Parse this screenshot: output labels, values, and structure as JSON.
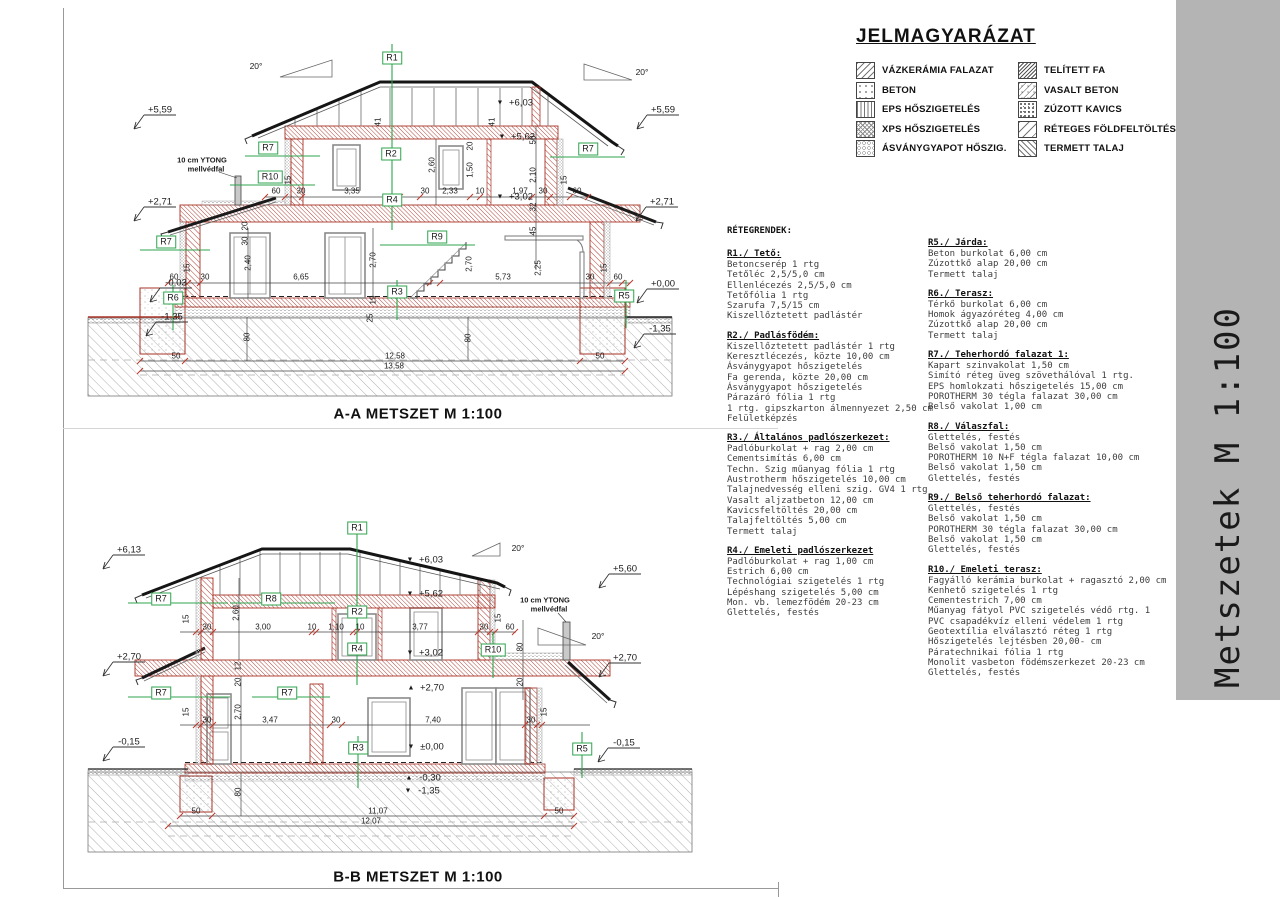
{
  "titlebar": {
    "text": "Metszetek M 1:100",
    "bg": "#b4b4b4"
  },
  "legend": {
    "title": "JELMAGYARÁZAT",
    "items_left": [
      {
        "label": "VÁZKERÁMIA FALAZAT",
        "pattern": "diag"
      },
      {
        "label": "BETON",
        "pattern": "dots"
      },
      {
        "label": "EPS HŐSZIGETELÉS",
        "pattern": "zigzag"
      },
      {
        "label": "XPS HŐSZIGETELÉS",
        "pattern": "honey"
      },
      {
        "label": "ÁSVÁNYGYAPOT HŐSZIG.",
        "pattern": "wavy"
      }
    ],
    "items_right": [
      {
        "label": "TELÍTETT FA",
        "pattern": "wood"
      },
      {
        "label": "VASALT BETON",
        "pattern": "rebar"
      },
      {
        "label": "ZÚZOTT KAVICS",
        "pattern": "gravel"
      },
      {
        "label": "RÉTEGES FÖLDFELTÖLTÉS",
        "pattern": "fill"
      },
      {
        "label": "TERMETT TALAJ",
        "pattern": "soil"
      }
    ]
  },
  "layers": {
    "heading": "RÉTEGRENDEK:",
    "left": [
      {
        "title": "R1./ Tető:",
        "lines": [
          "Betoncserép 1 rtg",
          "Tetőléc 2,5/5,0 cm",
          "Ellenlécezés 2,5/5,0 cm",
          "Tetőfólia 1 rtg",
          "Szarufa 7,5/15 cm",
          "Kiszellőztetett padlástér"
        ]
      },
      {
        "title": "R2./ Padlásfödém:",
        "lines": [
          "Kiszellőztetett padlástér 1 rtg",
          "Keresztlécezés, közte 10,00 cm",
          "Ásványgyapot hőszigetelés",
          "Fa gerenda, közte 20,00 cm",
          "Ásványgyapot hőszigetelés",
          "Párazáró fólia 1 rtg",
          "1 rtg. gipszkarton álmennyezet 2,50 cm",
          "Felületképzés"
        ]
      },
      {
        "title": "R3./ Általános padlószerkezet:",
        "lines": [
          "Padlóburkolat + rag 2,00 cm",
          "Cementsimítás 6,00 cm",
          "Techn. Szig műanyag fólia 1 rtg",
          "Austrotherm hőszigetelés 10,00 cm",
          "Talajnedvesség elleni szig. GV4 1 rtg",
          "Vasalt aljzatbeton 12,00 cm",
          "Kavicsfeltöltés 20,00 cm",
          "Talajfeltöltés 5,00 cm",
          "Termett talaj"
        ]
      },
      {
        "title": "R4./ Emeleti padlószerkezet",
        "lines": [
          "Padlóburkolat + rag 1,00 cm",
          "Estrich 6,00 cm",
          "Technológiai szigetelés 1 rtg",
          "Lépéshang szigetelés 5,00 cm",
          "Mon. vb. lemezfödém 20-23 cm",
          "Glettelés, festés"
        ]
      }
    ],
    "right": [
      {
        "title": "R5./ Járda:",
        "lines": [
          "Beton burkolat 6,00 cm",
          "Zúzottkő alap 20,00 cm",
          "Termett talaj"
        ]
      },
      {
        "title": "R6./ Terasz:",
        "lines": [
          "Térkő burkolat 6,00 cm",
          "Homok ágyazóréteg 4,00 cm",
          "Zúzottkő alap 20,00 cm",
          "Termett talaj"
        ]
      },
      {
        "title": "R7./ Teherhordó falazat 1:",
        "lines": [
          "Kapart szinvakolat 1,50 cm",
          "Simító réteg üveg szövethálóval 1 rtg.",
          "EPS homlokzati hőszigetelés 15,00 cm",
          "POROTHERM 30 tégla falazat 30,00 cm",
          "Belső vakolat 1,00 cm"
        ]
      },
      {
        "title": "R8./ Válaszfal:",
        "lines": [
          "Glettelés, festés",
          "Belső vakolat 1,50 cm",
          "POROTHERM 10 N+F tégla falazat 10,00 cm",
          "Belső vakolat 1,50 cm",
          "Glettelés, festés"
        ]
      },
      {
        "title": "R9./ Belső teherhordó falazat:",
        "lines": [
          "Glettelés, festés",
          "Belső vakolat 1,50 cm",
          "POROTHERM 30 tégla falazat 30,00 cm",
          "Belső vakolat 1,50 cm",
          "Glettelés, festés"
        ]
      },
      {
        "title": "R10./ Emeleti terasz:",
        "lines": [
          "Fagyálló kerámia burkolat + ragasztó 2,00 cm",
          "Kenhető szigetelés  1 rtg",
          "Cementestrich  7,00 cm",
          "Műanyag fátyol PVC szigetelés védő rtg.  1",
          "PVC csapadékvíz elleni védelem 1 rtg",
          "Geotextília elválasztó réteg  1 rtg",
          "Hőszigetelés lejtésben  20,00- cm",
          "Páratechnikai fólia 1 rtg",
          "Monolit vasbeton födémszerkezet 20-23 cm",
          "Glettelés, festés"
        ]
      }
    ]
  },
  "section_a": {
    "title": "A-A METSZET M 1:100",
    "labels": [
      {
        "t": "+5,59",
        "x": 80,
        "y": 80,
        "cls": "elev"
      },
      {
        "t": "+2,71",
        "x": 80,
        "y": 172,
        "cls": "elev"
      },
      {
        "t": "-0,03",
        "x": 96,
        "y": 253,
        "cls": "elev"
      },
      {
        "t": "-1,35",
        "x": 92,
        "y": 287,
        "cls": "elev"
      },
      {
        "t": "+5,59",
        "x": 583,
        "y": 80,
        "cls": "elev"
      },
      {
        "t": "+2,71",
        "x": 582,
        "y": 172,
        "cls": "elev"
      },
      {
        "t": "+0,00",
        "x": 583,
        "y": 254,
        "cls": "elev"
      },
      {
        "t": "-1,35",
        "x": 580,
        "y": 299,
        "cls": "elev"
      },
      {
        "t": "▼",
        "x": 420,
        "y": 73,
        "cls": "tri"
      },
      {
        "t": "+6,03",
        "x": 441,
        "y": 73,
        "cls": "elev"
      },
      {
        "t": "▼",
        "x": 422,
        "y": 107,
        "cls": "tri"
      },
      {
        "t": "+5,62",
        "x": 443,
        "y": 107,
        "cls": "elev"
      },
      {
        "t": "▼",
        "x": 420,
        "y": 167,
        "cls": "tri"
      },
      {
        "t": "+3,02",
        "x": 441,
        "y": 167,
        "cls": "elev"
      },
      {
        "t": "20°",
        "x": 176,
        "y": 36,
        "cls": "deg"
      },
      {
        "t": "20°",
        "x": 562,
        "y": 42,
        "cls": "deg"
      },
      {
        "t": "R1",
        "x": 312,
        "y": 28,
        "cls": "rbox"
      },
      {
        "t": "R2",
        "x": 311,
        "y": 124,
        "cls": "rbox"
      },
      {
        "t": "R4",
        "x": 312,
        "y": 170,
        "cls": "rbox"
      },
      {
        "t": "R7",
        "x": 188,
        "y": 118,
        "cls": "rbox"
      },
      {
        "t": "R10",
        "x": 190,
        "y": 147,
        "cls": "rbox"
      },
      {
        "t": "R7",
        "x": 86,
        "y": 212,
        "cls": "rbox"
      },
      {
        "t": "R9",
        "x": 357,
        "y": 207,
        "cls": "rbox"
      },
      {
        "t": "R3",
        "x": 317,
        "y": 262,
        "cls": "rbox"
      },
      {
        "t": "R6",
        "x": 93,
        "y": 268,
        "cls": "rbox"
      },
      {
        "t": "R7",
        "x": 508,
        "y": 119,
        "cls": "rbox"
      },
      {
        "t": "R5",
        "x": 544,
        "y": 266,
        "cls": "rbox"
      },
      {
        "t": "10 cm YTONG",
        "x": 122,
        "y": 130,
        "cls": "note"
      },
      {
        "t": "mellvédfal",
        "x": 126,
        "y": 139,
        "cls": "note"
      },
      {
        "t": "60",
        "x": 196,
        "y": 161,
        "cls": "dim"
      },
      {
        "t": "30",
        "x": 221,
        "y": 161,
        "cls": "dim"
      },
      {
        "t": "3,35",
        "x": 272,
        "y": 161,
        "cls": "dim"
      },
      {
        "t": "30",
        "x": 345,
        "y": 161,
        "cls": "dim"
      },
      {
        "t": "2,33",
        "x": 370,
        "y": 161,
        "cls": "dim"
      },
      {
        "t": "10",
        "x": 400,
        "y": 161,
        "cls": "dim"
      },
      {
        "t": "1,97",
        "x": 440,
        "y": 161,
        "cls": "dim"
      },
      {
        "t": "30",
        "x": 463,
        "y": 161,
        "cls": "dim"
      },
      {
        "t": "60",
        "x": 497,
        "y": 161,
        "cls": "dim"
      },
      {
        "t": "15",
        "x": 484,
        "y": 150,
        "cls": "dimv"
      },
      {
        "t": "15",
        "x": 208,
        "y": 150,
        "cls": "dimv"
      },
      {
        "t": "2,60",
        "x": 352,
        "y": 135,
        "cls": "dimv"
      },
      {
        "t": "1,50",
        "x": 390,
        "y": 140,
        "cls": "dimv"
      },
      {
        "t": "20",
        "x": 390,
        "y": 116,
        "cls": "dimv"
      },
      {
        "t": "41",
        "x": 298,
        "y": 92,
        "cls": "dimv"
      },
      {
        "t": "41",
        "x": 412,
        "y": 92,
        "cls": "dimv"
      },
      {
        "t": "50",
        "x": 453,
        "y": 110,
        "cls": "dimv"
      },
      {
        "t": "2,10",
        "x": 453,
        "y": 145,
        "cls": "dimv"
      },
      {
        "t": "32",
        "x": 453,
        "y": 177,
        "cls": "dimv"
      },
      {
        "t": "45",
        "x": 453,
        "y": 201,
        "cls": "dimv"
      },
      {
        "t": "20",
        "x": 165,
        "y": 196,
        "cls": "dimv"
      },
      {
        "t": "30",
        "x": 165,
        "y": 211,
        "cls": "dimv"
      },
      {
        "t": "60",
        "x": 94,
        "y": 247,
        "cls": "dim"
      },
      {
        "t": "30",
        "x": 125,
        "y": 247,
        "cls": "dim"
      },
      {
        "t": "6,65",
        "x": 221,
        "y": 247,
        "cls": "dim"
      },
      {
        "t": "5,73",
        "x": 423,
        "y": 247,
        "cls": "dim"
      },
      {
        "t": "30",
        "x": 510,
        "y": 247,
        "cls": "dim"
      },
      {
        "t": "60",
        "x": 538,
        "y": 247,
        "cls": "dim"
      },
      {
        "t": "15",
        "x": 107,
        "y": 238,
        "cls": "dimv"
      },
      {
        "t": "15",
        "x": 524,
        "y": 238,
        "cls": "dimv"
      },
      {
        "t": "2,40",
        "x": 168,
        "y": 233,
        "cls": "dimv"
      },
      {
        "t": "2,70",
        "x": 293,
        "y": 230,
        "cls": "dimv"
      },
      {
        "t": "2,70",
        "x": 389,
        "y": 234,
        "cls": "dimv"
      },
      {
        "t": "2,25",
        "x": 458,
        "y": 238,
        "cls": "dimv"
      },
      {
        "t": "19",
        "x": 293,
        "y": 270,
        "cls": "dimv"
      },
      {
        "t": "25",
        "x": 290,
        "y": 288,
        "cls": "dimv"
      },
      {
        "t": "80",
        "x": 167,
        "y": 307,
        "cls": "dimv"
      },
      {
        "t": "80",
        "x": 388,
        "y": 308,
        "cls": "dimv"
      },
      {
        "t": "50",
        "x": 96,
        "y": 326,
        "cls": "dim"
      },
      {
        "t": "12,58",
        "x": 315,
        "y": 326,
        "cls": "dim"
      },
      {
        "t": "50",
        "x": 520,
        "y": 326,
        "cls": "dim"
      },
      {
        "t": "13,58",
        "x": 314,
        "y": 336,
        "cls": "dim"
      }
    ]
  },
  "section_b": {
    "title": "B-B METSZET M 1:100",
    "labels": [
      {
        "t": "+6,13",
        "x": 49,
        "y": 30,
        "cls": "elev"
      },
      {
        "t": "+2,70",
        "x": 49,
        "y": 137,
        "cls": "elev"
      },
      {
        "t": "-0,15",
        "x": 49,
        "y": 222,
        "cls": "elev"
      },
      {
        "t": "+5,60",
        "x": 545,
        "y": 49,
        "cls": "elev"
      },
      {
        "t": "+2,70",
        "x": 545,
        "y": 138,
        "cls": "elev"
      },
      {
        "t": "-0,15",
        "x": 544,
        "y": 223,
        "cls": "elev"
      },
      {
        "t": "▼",
        "x": 330,
        "y": 40,
        "cls": "tri"
      },
      {
        "t": "+6,03",
        "x": 351,
        "y": 40,
        "cls": "elev"
      },
      {
        "t": "▼",
        "x": 330,
        "y": 74,
        "cls": "tri"
      },
      {
        "t": "+5,62",
        "x": 351,
        "y": 74,
        "cls": "elev"
      },
      {
        "t": "▼",
        "x": 330,
        "y": 133,
        "cls": "tri"
      },
      {
        "t": "+3,02",
        "x": 351,
        "y": 133,
        "cls": "elev"
      },
      {
        "t": "▲",
        "x": 331,
        "y": 168,
        "cls": "tri"
      },
      {
        "t": "+2,70",
        "x": 352,
        "y": 168,
        "cls": "elev"
      },
      {
        "t": "▼",
        "x": 331,
        "y": 227,
        "cls": "tri"
      },
      {
        "t": "±0,00",
        "x": 352,
        "y": 227,
        "cls": "elev"
      },
      {
        "t": "▲",
        "x": 329,
        "y": 258,
        "cls": "tri"
      },
      {
        "t": "-0,30",
        "x": 350,
        "y": 258,
        "cls": "elev"
      },
      {
        "t": "▼",
        "x": 328,
        "y": 271,
        "cls": "tri"
      },
      {
        "t": "-1,35",
        "x": 349,
        "y": 271,
        "cls": "elev"
      },
      {
        "t": "20°",
        "x": 438,
        "y": 28,
        "cls": "deg"
      },
      {
        "t": "20°",
        "x": 518,
        "y": 116,
        "cls": "deg"
      },
      {
        "t": "R1",
        "x": 277,
        "y": 8,
        "cls": "rbox"
      },
      {
        "t": "R2",
        "x": 277,
        "y": 92,
        "cls": "rbox"
      },
      {
        "t": "R4",
        "x": 277,
        "y": 129,
        "cls": "rbox"
      },
      {
        "t": "R8",
        "x": 191,
        "y": 79,
        "cls": "rbox"
      },
      {
        "t": "R7",
        "x": 81,
        "y": 79,
        "cls": "rbox"
      },
      {
        "t": "R7",
        "x": 81,
        "y": 173,
        "cls": "rbox"
      },
      {
        "t": "R7",
        "x": 207,
        "y": 173,
        "cls": "rbox"
      },
      {
        "t": "R10",
        "x": 413,
        "y": 130,
        "cls": "rbox"
      },
      {
        "t": "R3",
        "x": 278,
        "y": 228,
        "cls": "rbox"
      },
      {
        "t": "R5",
        "x": 502,
        "y": 229,
        "cls": "rbox"
      },
      {
        "t": "10 cm YTONG",
        "x": 465,
        "y": 80,
        "cls": "note"
      },
      {
        "t": "mellvédfal",
        "x": 469,
        "y": 89,
        "cls": "note"
      },
      {
        "t": "15",
        "x": 106,
        "y": 99,
        "cls": "dimv"
      },
      {
        "t": "30",
        "x": 127,
        "y": 107,
        "cls": "dim"
      },
      {
        "t": "3,00",
        "x": 183,
        "y": 107,
        "cls": "dim"
      },
      {
        "t": "10",
        "x": 232,
        "y": 107,
        "cls": "dim"
      },
      {
        "t": "1,10",
        "x": 256,
        "y": 107,
        "cls": "dim"
      },
      {
        "t": "10",
        "x": 280,
        "y": 107,
        "cls": "dim"
      },
      {
        "t": "3,77",
        "x": 340,
        "y": 107,
        "cls": "dim"
      },
      {
        "t": "30",
        "x": 404,
        "y": 107,
        "cls": "dim"
      },
      {
        "t": "15",
        "x": 418,
        "y": 98,
        "cls": "dimv"
      },
      {
        "t": "60",
        "x": 430,
        "y": 107,
        "cls": "dim"
      },
      {
        "t": "2,60",
        "x": 156,
        "y": 93,
        "cls": "dimv"
      },
      {
        "t": "12",
        "x": 158,
        "y": 146,
        "cls": "dimv"
      },
      {
        "t": "20",
        "x": 158,
        "y": 162,
        "cls": "dimv"
      },
      {
        "t": "80",
        "x": 440,
        "y": 127,
        "cls": "dimv"
      },
      {
        "t": "20",
        "x": 440,
        "y": 162,
        "cls": "dimv"
      },
      {
        "t": "15",
        "x": 106,
        "y": 192,
        "cls": "dimv"
      },
      {
        "t": "30",
        "x": 127,
        "y": 200,
        "cls": "dim"
      },
      {
        "t": "2,70",
        "x": 158,
        "y": 192,
        "cls": "dimv"
      },
      {
        "t": "3,47",
        "x": 190,
        "y": 200,
        "cls": "dim"
      },
      {
        "t": "30",
        "x": 256,
        "y": 200,
        "cls": "dim"
      },
      {
        "t": "7,40",
        "x": 353,
        "y": 200,
        "cls": "dim"
      },
      {
        "t": "30",
        "x": 451,
        "y": 200,
        "cls": "dim"
      },
      {
        "t": "15",
        "x": 464,
        "y": 192,
        "cls": "dimv"
      },
      {
        "t": "80",
        "x": 158,
        "y": 272,
        "cls": "dimv"
      },
      {
        "t": "50",
        "x": 116,
        "y": 291,
        "cls": "dim"
      },
      {
        "t": "11,07",
        "x": 298,
        "y": 291,
        "cls": "dim"
      },
      {
        "t": "50",
        "x": 479,
        "y": 291,
        "cls": "dim"
      },
      {
        "t": "12,07",
        "x": 291,
        "y": 301,
        "cls": "dim"
      }
    ]
  }
}
